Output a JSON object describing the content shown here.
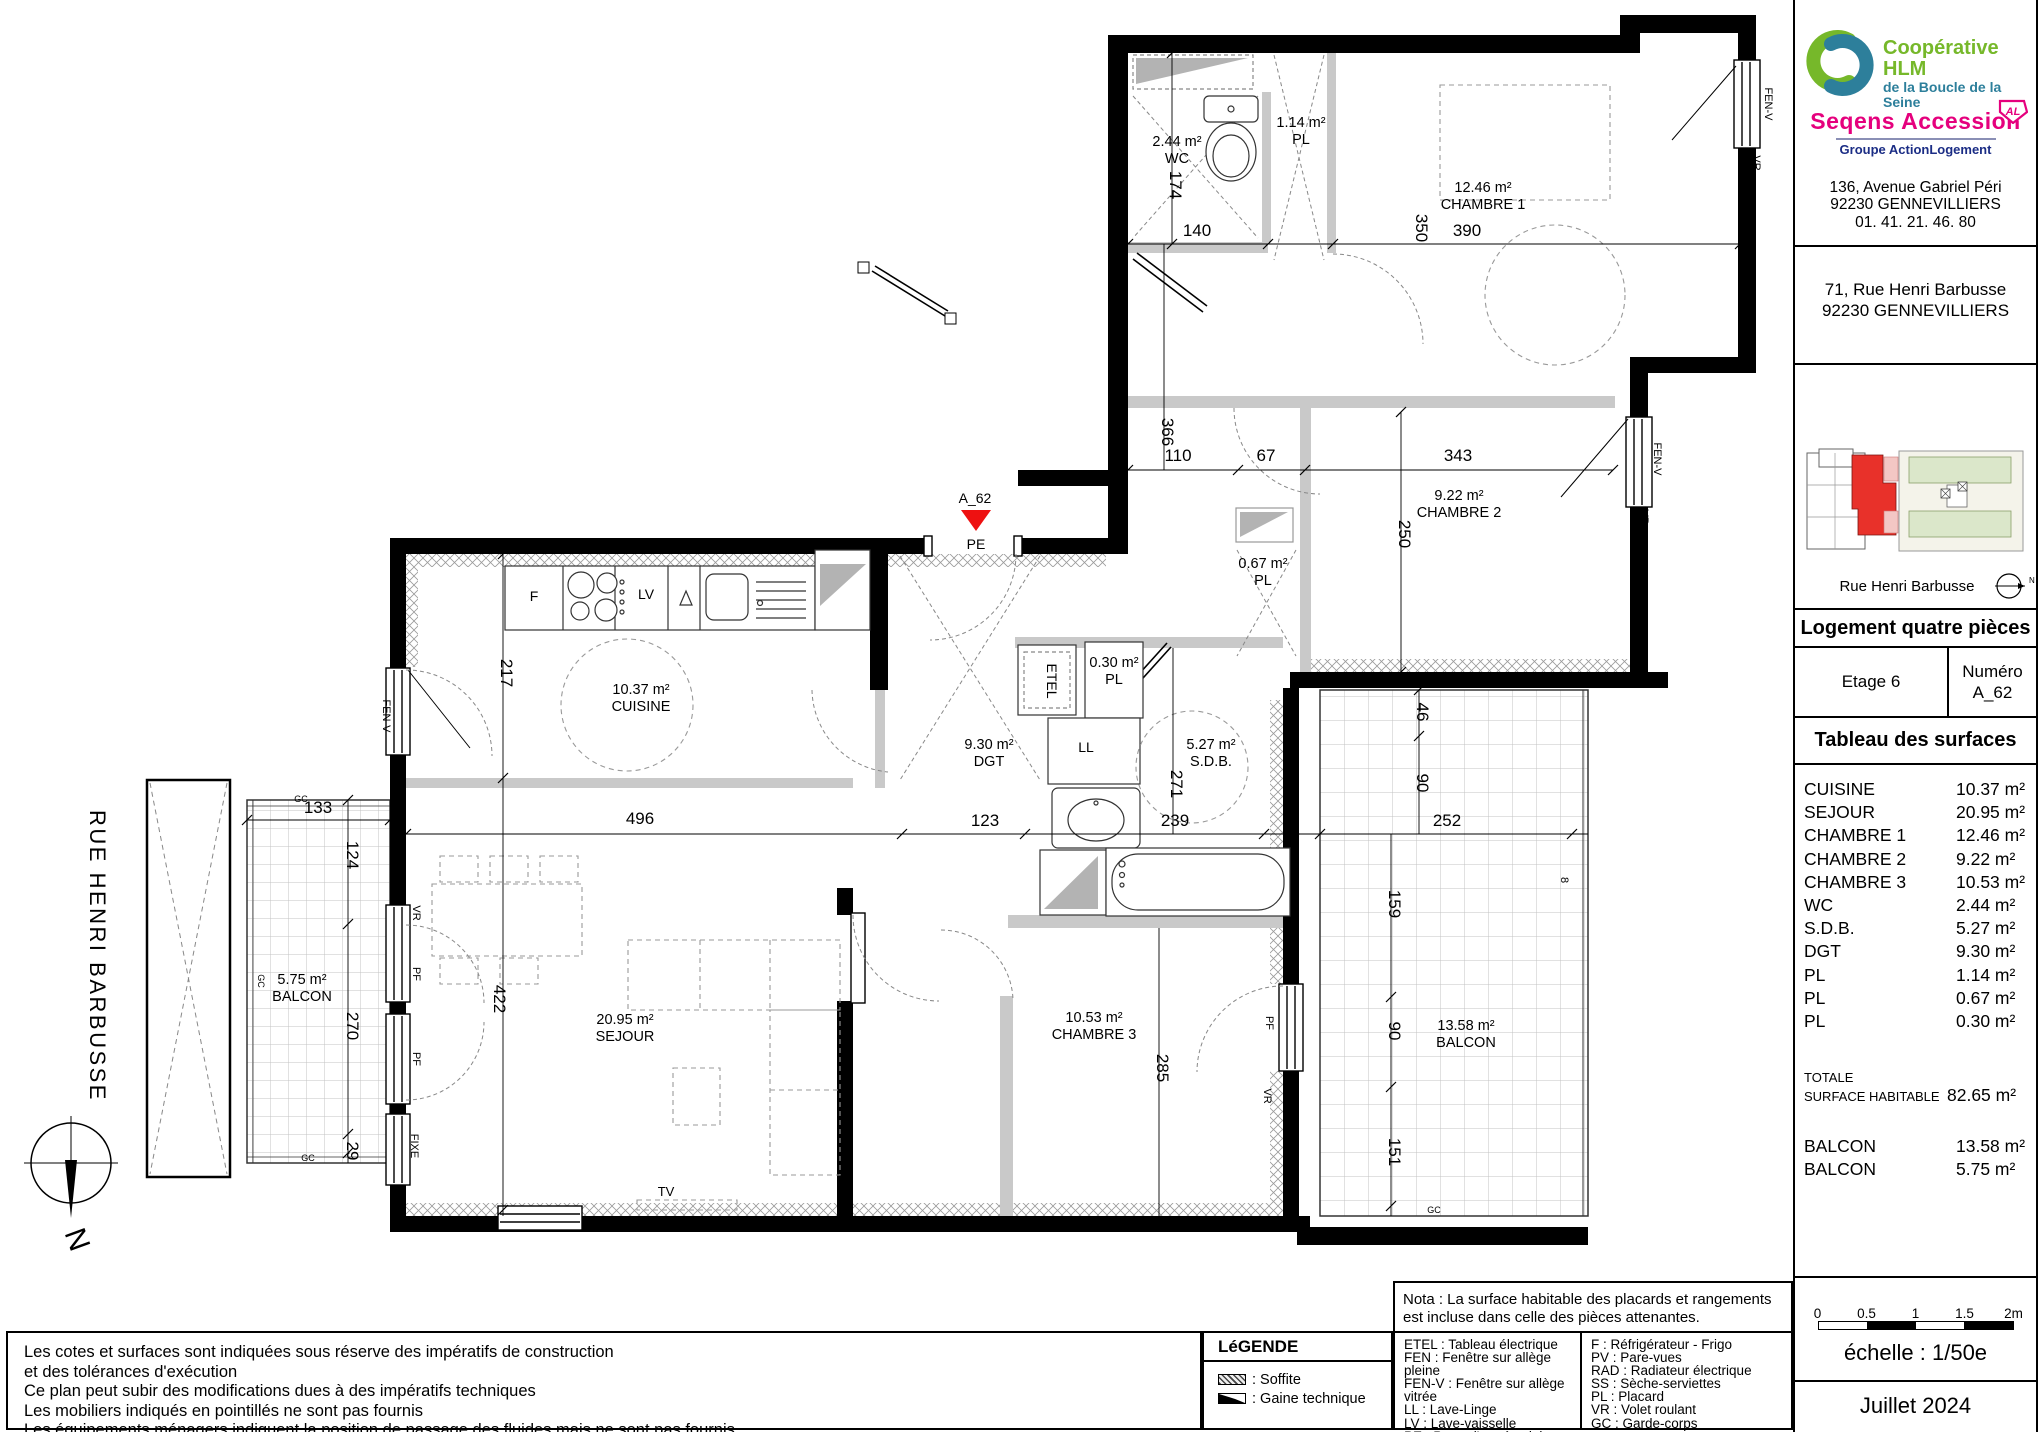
{
  "plan": {
    "street_label": "RUE HENRI BARBUSSE",
    "north_label": "N",
    "entry_marker": {
      "unit": "A_62",
      "door_label": "PE"
    },
    "rooms": [
      {
        "area": "2.44 m²",
        "name": "WC",
        "x": 1177,
        "y": 146
      },
      {
        "area": "1.14 m²",
        "name": "PL",
        "x": 1301,
        "y": 127
      },
      {
        "area": "12.46 m²",
        "name": "CHAMBRE 1",
        "x": 1483,
        "y": 192
      },
      {
        "area": "9.22 m²",
        "name": "CHAMBRE 2",
        "x": 1459,
        "y": 500
      },
      {
        "area": "0.67 m²",
        "name": "PL",
        "x": 1263,
        "y": 568
      },
      {
        "area": "0.30 m²",
        "name": "PL",
        "x": 1114,
        "y": 667
      },
      {
        "area": "10.37 m²",
        "name": "CUISINE",
        "x": 641,
        "y": 694
      },
      {
        "area": "9.30 m²",
        "name": "DGT",
        "x": 989,
        "y": 749
      },
      {
        "area": "5.27 m²",
        "name": "S.D.B.",
        "x": 1211,
        "y": 749
      },
      {
        "area": "20.95 m²",
        "name": "SEJOUR",
        "x": 625,
        "y": 1024
      },
      {
        "area": "10.53 m²",
        "name": "CHAMBRE 3",
        "x": 1094,
        "y": 1022
      },
      {
        "area": "13.58 m²",
        "name": "BALCON",
        "x": 1466,
        "y": 1030
      },
      {
        "area": "5.75 m²",
        "name": "BALCON",
        "x": 302,
        "y": 984
      }
    ],
    "dimensions": [
      {
        "v": "174",
        "x": 1170,
        "y": 185,
        "r": 90
      },
      {
        "v": "140",
        "x": 1197,
        "y": 236
      },
      {
        "v": "350",
        "x": 1416,
        "y": 228,
        "r": 90
      },
      {
        "v": "390",
        "x": 1467,
        "y": 236
      },
      {
        "v": "366",
        "x": 1162,
        "y": 432,
        "r": 90
      },
      {
        "v": "110",
        "x": 1178,
        "y": 461
      },
      {
        "v": "67",
        "x": 1266,
        "y": 461
      },
      {
        "v": "343",
        "x": 1458,
        "y": 461
      },
      {
        "v": "250",
        "x": 1399,
        "y": 534,
        "r": 90
      },
      {
        "v": "217",
        "x": 501,
        "y": 673,
        "r": 90
      },
      {
        "v": "496",
        "x": 640,
        "y": 824
      },
      {
        "v": "123",
        "x": 985,
        "y": 826
      },
      {
        "v": "239",
        "x": 1175,
        "y": 826
      },
      {
        "v": "252",
        "x": 1447,
        "y": 826
      },
      {
        "v": "46",
        "x": 1417,
        "y": 712,
        "r": 90
      },
      {
        "v": "90",
        "x": 1417,
        "y": 783,
        "r": 90
      },
      {
        "v": "159",
        "x": 1389,
        "y": 904,
        "r": 90
      },
      {
        "v": "90",
        "x": 1389,
        "y": 1031,
        "r": 90
      },
      {
        "v": "151",
        "x": 1389,
        "y": 1152,
        "r": 90
      },
      {
        "v": "271",
        "x": 1171,
        "y": 784,
        "r": 90
      },
      {
        "v": "285",
        "x": 1157,
        "y": 1068,
        "r": 90
      },
      {
        "v": "422",
        "x": 494,
        "y": 999,
        "r": 90
      },
      {
        "v": "133",
        "x": 318,
        "y": 813
      },
      {
        "v": "124",
        "x": 347,
        "y": 855,
        "r": 90
      },
      {
        "v": "270",
        "x": 347,
        "y": 1026,
        "r": 90
      },
      {
        "v": "29",
        "x": 347,
        "y": 1151,
        "r": 90
      },
      {
        "v": "8",
        "x": 1561,
        "y": 880,
        "r": 90,
        "s": 11
      }
    ],
    "annotations": [
      {
        "t": "ETEL",
        "x": 1047,
        "y": 681,
        "r": 90,
        "s": 14
      },
      {
        "t": "LL",
        "x": 1086,
        "y": 752,
        "s": 14
      },
      {
        "t": "F",
        "x": 534,
        "y": 601,
        "s": 14
      },
      {
        "t": "LV",
        "x": 646,
        "y": 599,
        "s": 14
      },
      {
        "t": "TV",
        "x": 666,
        "y": 1196,
        "s": 13
      },
      {
        "t": "FEN-V",
        "x": 1765,
        "y": 104,
        "r": 90,
        "s": 11
      },
      {
        "t": "VR",
        "x": 1753,
        "y": 163,
        "r": 90,
        "s": 11
      },
      {
        "t": "FEN-V",
        "x": 1654,
        "y": 459,
        "r": 90,
        "s": 11
      },
      {
        "t": "VR",
        "x": 1641,
        "y": 517,
        "r": 90,
        "s": 11
      },
      {
        "t": "FEN-V",
        "x": 383,
        "y": 716,
        "r": 90,
        "s": 11
      },
      {
        "t": "VR",
        "x": 413,
        "y": 913,
        "r": 90,
        "s": 11
      },
      {
        "t": "PF",
        "x": 413,
        "y": 974,
        "r": 90,
        "s": 11
      },
      {
        "t": "PF",
        "x": 413,
        "y": 1059,
        "r": 90,
        "s": 11
      },
      {
        "t": "FIXE",
        "x": 411,
        "y": 1146,
        "r": 90,
        "s": 11
      },
      {
        "t": "PF",
        "x": 1266,
        "y": 1023,
        "r": 90,
        "s": 11
      },
      {
        "t": "VR",
        "x": 1264,
        "y": 1096,
        "r": 90,
        "s": 11
      },
      {
        "t": "GC",
        "x": 301,
        "y": 802,
        "s": 9
      },
      {
        "t": "GC",
        "x": 258,
        "y": 981,
        "r": 90,
        "s": 9
      },
      {
        "t": "GC",
        "x": 308,
        "y": 1161,
        "s": 9
      },
      {
        "t": "GC",
        "x": 1434,
        "y": 1213,
        "s": 9
      }
    ]
  },
  "sidebar": {
    "coop_logo": {
      "line1": "Coopérative HLM",
      "line2": "de la Boucle de la Seine"
    },
    "seqens_logo": {
      "name": "Seqens Accession",
      "badge": "AL",
      "subtitle": "Groupe ActionLogement"
    },
    "coop_address": [
      "136, Avenue Gabriel Péri",
      "92230 GENNEVILLIERS",
      "01. 41. 21. 46. 80"
    ],
    "project_address": [
      "71, Rue Henri Barbusse",
      "92230 GENNEVILLIERS"
    ],
    "key_plan": {
      "street": "Rue Henri Barbusse",
      "north": "N"
    },
    "unit_type": "Logement quatre pièces",
    "floor": "Etage 6",
    "numero_label": "Numéro",
    "numero_value": "A_62",
    "surface_table": {
      "title": "Tableau des surfaces",
      "rows": [
        [
          "CUISINE",
          "10.37 m²"
        ],
        [
          "SEJOUR",
          "20.95 m²"
        ],
        [
          "CHAMBRE 1",
          "12.46 m²"
        ],
        [
          "CHAMBRE 2",
          "9.22 m²"
        ],
        [
          "CHAMBRE 3",
          "10.53 m²"
        ],
        [
          "WC",
          "2.44 m²"
        ],
        [
          "S.D.B.",
          "5.27 m²"
        ],
        [
          "DGT",
          "9.30 m²"
        ],
        [
          "PL",
          "1.14 m²"
        ],
        [
          "PL",
          "0.67 m²"
        ],
        [
          "PL",
          "0.30 m²"
        ]
      ],
      "total_label_1": "TOTALE",
      "total_label_2": "SURFACE HABITABLE",
      "total_value": "82.65 m²",
      "balconies": [
        [
          "BALCON",
          "13.58 m²"
        ],
        [
          "BALCON",
          "5.75 m²"
        ]
      ]
    },
    "scale": {
      "ticks": [
        "0",
        "0.5",
        "1",
        "1.5",
        "2m"
      ],
      "label": "échelle : 1/50e"
    },
    "date": "Juillet 2024"
  },
  "footer": {
    "notes": [
      "Les cotes et surfaces sont indiquées sous réserve des impératifs de construction",
      "et des tolérances d'exécution",
      "Ce plan peut subir des modifications dues à des impératifs techniques",
      "Les mobiliers indiqués en pointillés ne sont pas fournis",
      "Les équipements ménagers indiquent la position de passage des fluides mais ne sont pas fournis"
    ],
    "legend": {
      "title": "LéGENDE",
      "items": [
        {
          "swatch": "soffite",
          "label": ": Soffite"
        },
        {
          "swatch": "gaine",
          "label": ": Gaine technique"
        }
      ]
    },
    "nota": "Nota : La surface habitable des placards et rangements est incluse dans celle des pièces attenantes.",
    "abbreviations": {
      "left": [
        "ETEL : Tableau électrique",
        "FEN : Fenêtre sur allège pleine",
        "FEN-V : Fenêtre sur allège vitrée",
        "LL : Lave-Linge",
        "LV : Lave-vaisselle",
        "PE : Porte d'entrée pleine",
        "PF : Porte-fenêtre vitrée"
      ],
      "right": [
        "F : Réfrigérateur -  Frigo",
        "PV : Pare-vues",
        "RAD : Radiateur électrique",
        "SS : Sèche-serviettes",
        "PL : Placard",
        "VR : Volet roulant",
        "GC : Garde-corps"
      ]
    }
  },
  "colors": {
    "accent_red": "#ee1111",
    "logo_green": "#76b82a",
    "logo_teal": "#2d7f9b",
    "logo_pink": "#e5007d",
    "logo_blue": "#1b2d85",
    "site_green": "#dbe7ca",
    "wall_black": "#000000",
    "partition_gray": "#c9c9c9",
    "soffite_gray": "#b3b3b3"
  }
}
